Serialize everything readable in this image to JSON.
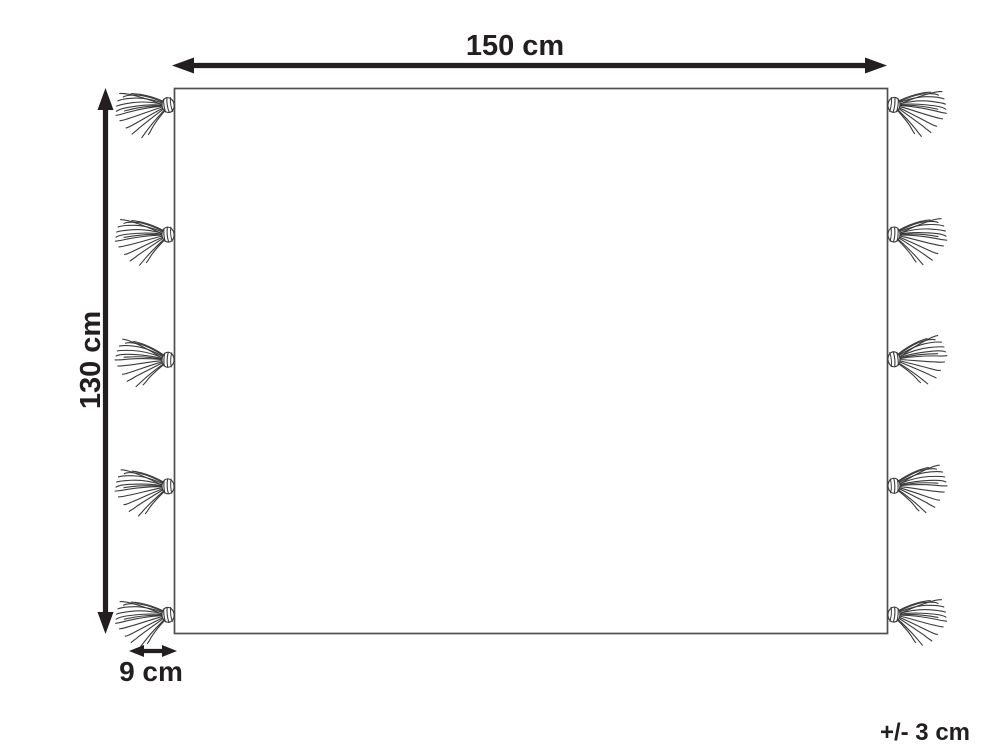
{
  "diagram": {
    "kind": "product-dimension-diagram",
    "dimensions": {
      "width": {
        "label": "150 cm"
      },
      "height": {
        "label": "130 cm"
      },
      "fringe": {
        "label": "9 cm"
      },
      "tolerance": {
        "label": "+/- 3 cm"
      }
    },
    "tassels": {
      "per_side": 5,
      "sides": [
        "left",
        "right"
      ]
    },
    "colors": {
      "line": "#231f20",
      "outline": "#4d4f52",
      "strand": "#3a3a3a",
      "background": "#ffffff"
    }
  }
}
